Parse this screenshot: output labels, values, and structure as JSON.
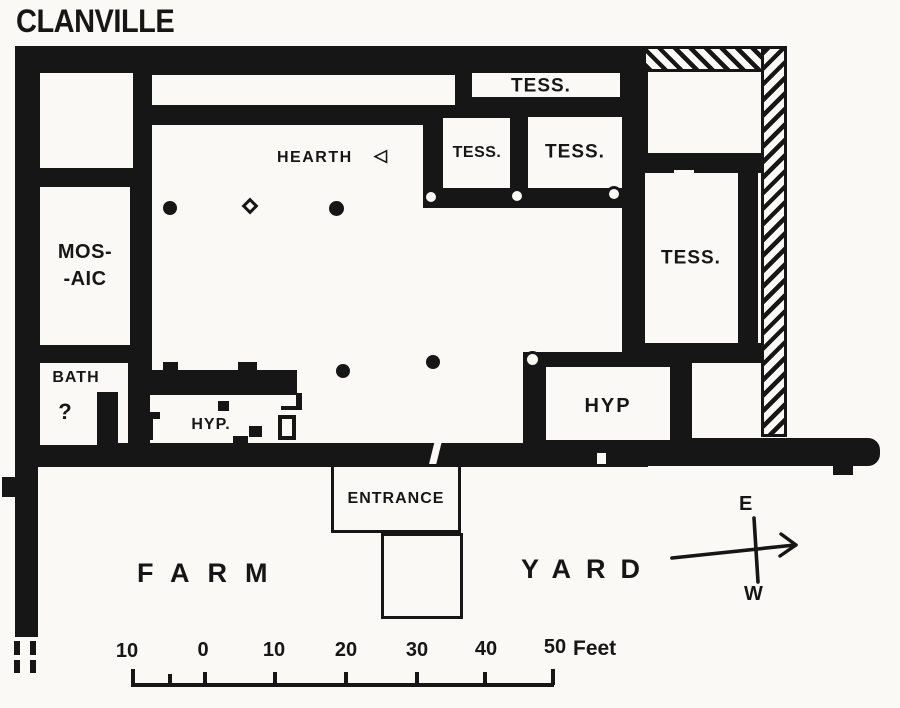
{
  "title": "CLANVILLE",
  "rooms": {
    "tess_top": "TESS.",
    "tess_small_left": "TESS.",
    "tess_small_right": "TESS.",
    "tess_right": "TESS.",
    "hearth": "HEARTH",
    "hearth_icon": "◁",
    "mosaic_line1": "MOS-",
    "mosaic_line2": "-AIC",
    "bath": "BATH",
    "bath_question": "?",
    "hyp_left": "HYP.",
    "hyp_right": "HYP",
    "entrance": "ENTRANCE"
  },
  "yard": {
    "farm": "FARM",
    "yard": "YARD"
  },
  "compass": {
    "east": "E",
    "west": "W"
  },
  "scalebar": {
    "labels": [
      "10",
      "0",
      "10",
      "20",
      "30",
      "40",
      "50"
    ],
    "unit": "Feet",
    "feet_per_division": 10
  },
  "colors": {
    "ink": "#161616",
    "paper": "#faf9f5"
  }
}
